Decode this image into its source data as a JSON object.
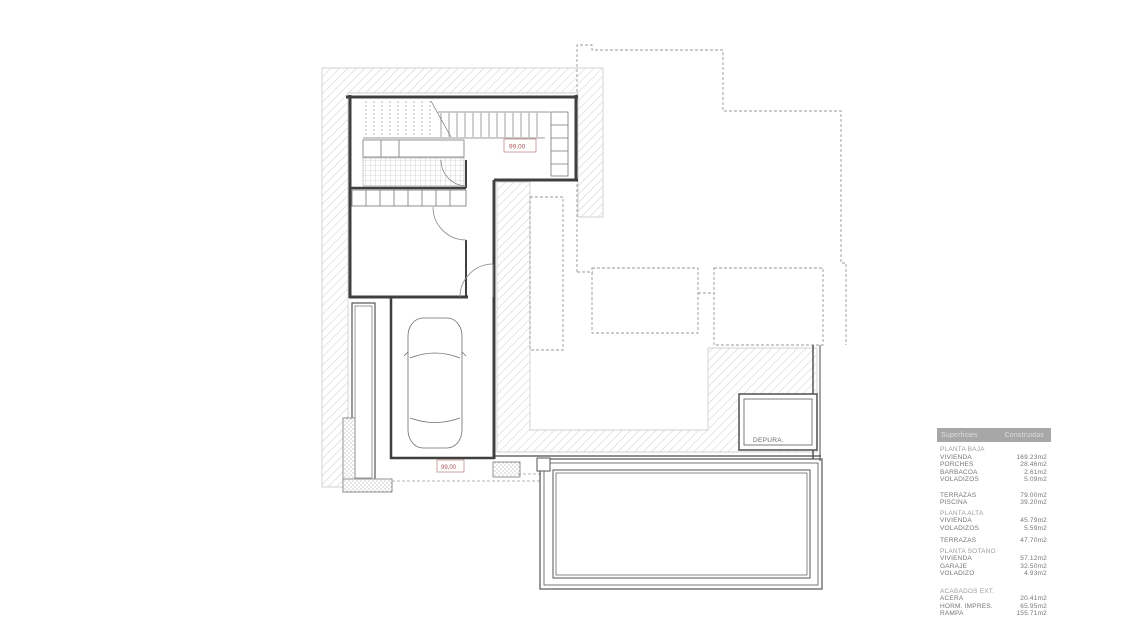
{
  "plan": {
    "level_label_upper": "99,00",
    "level_label_lower": "99,00",
    "depuradora_label": "DEPURA.",
    "colors": {
      "wall_line": "#3f3f3f",
      "thin_line": "#6e6e6e",
      "hatch_line": "#c9c9c9",
      "dashed_line": "#9a9a9a",
      "level_label_red": "#b05858",
      "table_header_bg": "#a7a7a7",
      "table_text": "#767676"
    }
  },
  "table": {
    "headers": [
      "Superficies",
      "Construidas"
    ],
    "sections": [
      {
        "title": "PLANTA BAJA",
        "rows": [
          {
            "label": "VIVIENDA",
            "value": "169.23m2"
          },
          {
            "label": "PORCHES",
            "value": "28.46m2"
          },
          {
            "label": "BARBACOA",
            "value": "2.61m2"
          },
          {
            "label": "VOLADIZOS",
            "value": "5.09m2"
          }
        ]
      },
      {
        "title": "",
        "rows": [
          {
            "label": "TERRAZAS",
            "value": "79.00m2"
          },
          {
            "label": "PISCINA",
            "value": "39.20m2"
          }
        ]
      },
      {
        "title": "PLANTA ALTA",
        "rows": [
          {
            "label": "VIVIENDA",
            "value": "45.79m2"
          },
          {
            "label": "VOLADIZOS",
            "value": "5.59m2"
          }
        ]
      },
      {
        "title": "",
        "rows": [
          {
            "label": "TERRAZAS",
            "value": "47.70m2"
          }
        ]
      },
      {
        "title": "PLANTA SOTANO",
        "rows": [
          {
            "label": "VIVIENDA",
            "value": "57.12m2"
          },
          {
            "label": "GARAJE",
            "value": "32.50m2"
          },
          {
            "label": "VOLADIZO",
            "value": "4.93m2"
          }
        ]
      },
      {
        "title": "ACABADOS EXT.",
        "rows": [
          {
            "label": "ACERA",
            "value": "20.41m2"
          },
          {
            "label": "HORM. IMPRES.",
            "value": "65.95m2"
          },
          {
            "label": "RAMPA",
            "value": "155.71m2"
          }
        ]
      }
    ]
  }
}
